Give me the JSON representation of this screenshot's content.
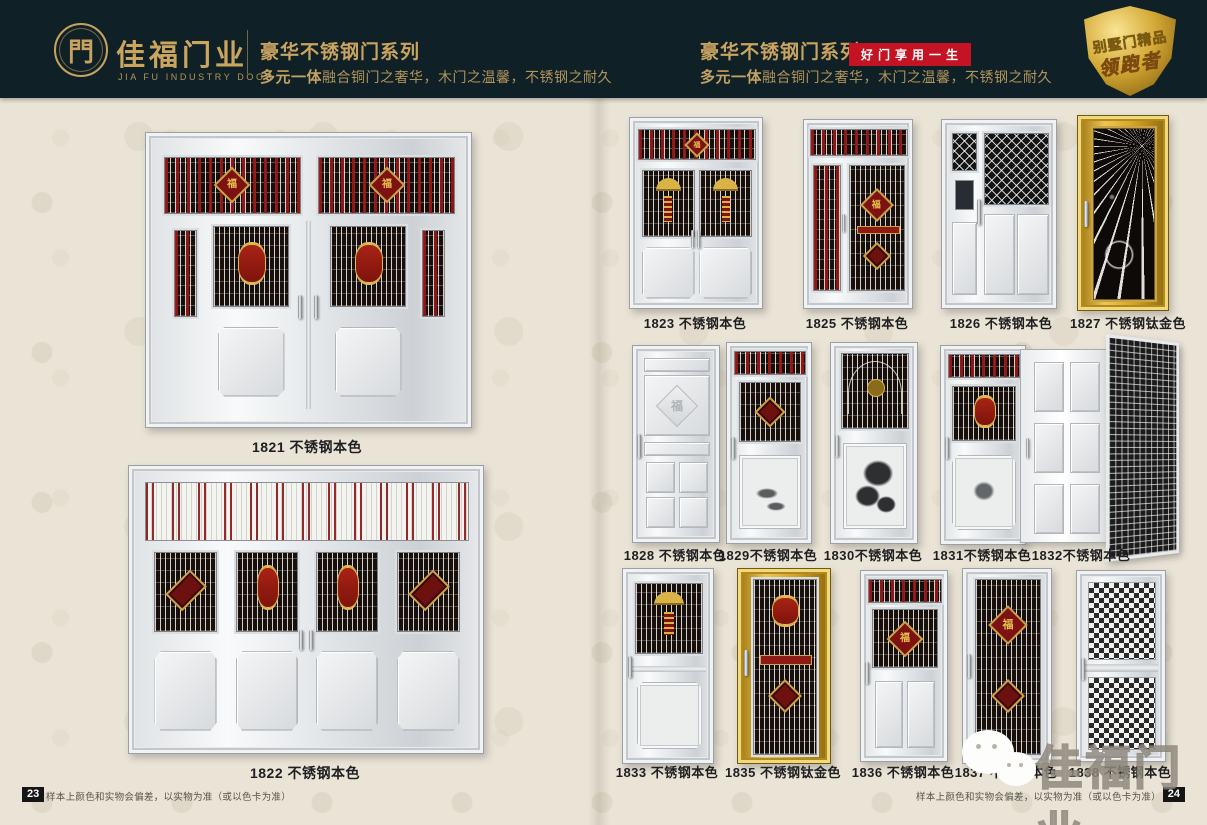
{
  "header": {
    "logo": {
      "symbol": "門",
      "brand": "佳福门业",
      "brand_en": "JIA FU INDUSTRY DOOR"
    },
    "left": {
      "series_title": "豪华不锈钢门系列",
      "tagline_bold": "多元一体",
      "tagline_rest": "融合铜门之奢华，木门之温馨，不锈钢之耐久"
    },
    "right": {
      "series_title": "豪华不锈钢门系列",
      "slogan_badge": "好门享用一生",
      "tagline_bold": "多元一体",
      "tagline_rest": "融合铜门之奢华，木门之温馨，不锈钢之耐久"
    },
    "corner_badge": {
      "line1": "别墅门精品",
      "line2": "领跑者"
    }
  },
  "decor": {
    "fu": "福"
  },
  "left_page": {
    "doors": [
      {
        "model": "1821",
        "finish": "不锈钢本色",
        "label": "1821 不锈钢本色"
      },
      {
        "model": "1822",
        "finish": "不锈钢本色",
        "label": "1822 不锈钢本色"
      }
    ],
    "footer": {
      "page_number": "23",
      "note": "样本上颜色和实物会偏差，以实物为准（或以色卡为准）"
    }
  },
  "right_page": {
    "row1": [
      {
        "model": "1823",
        "label": "1823 不锈钢本色"
      },
      {
        "model": "1825",
        "label": "1825 不锈钢本色"
      },
      {
        "model": "1826",
        "label": "1826 不锈钢本色"
      },
      {
        "model": "1827",
        "label": "1827 不锈钢钛金色"
      }
    ],
    "row2": [
      {
        "model": "1828",
        "label": "1828 不锈钢本色"
      },
      {
        "model": "1829",
        "label": "1829不锈钢本色"
      },
      {
        "model": "1830",
        "label": "1830不锈钢本色"
      },
      {
        "model": "1831",
        "label": "1831不锈钢本色"
      },
      {
        "model": "1832",
        "label": "1832不锈钢本色"
      }
    ],
    "row3": [
      {
        "model": "1833",
        "label": "1833 不锈钢本色"
      },
      {
        "model": "1835",
        "label": "1835 不锈钢钛金色"
      },
      {
        "model": "1836",
        "label": "1836 不锈钢本色"
      },
      {
        "model": "1837",
        "label": "1837 不锈钢本色"
      },
      {
        "model": "1838",
        "label": "1838 不锈钢本色"
      }
    ],
    "watermark": {
      "icon": "wechat-icon",
      "text": "佳福门业"
    },
    "footer": {
      "page_number": "24",
      "note": "样本上颜色和实物会偏差，以实物为准（或以色卡为准）"
    }
  },
  "colors": {
    "header_bg": "#0f2126",
    "accent_gold": "#c9a35f",
    "badge_red": "#c41424",
    "page_bg": "#e9e4d6",
    "caption_text": "#1f1f21",
    "titanium_gold": "#d3a326"
  }
}
